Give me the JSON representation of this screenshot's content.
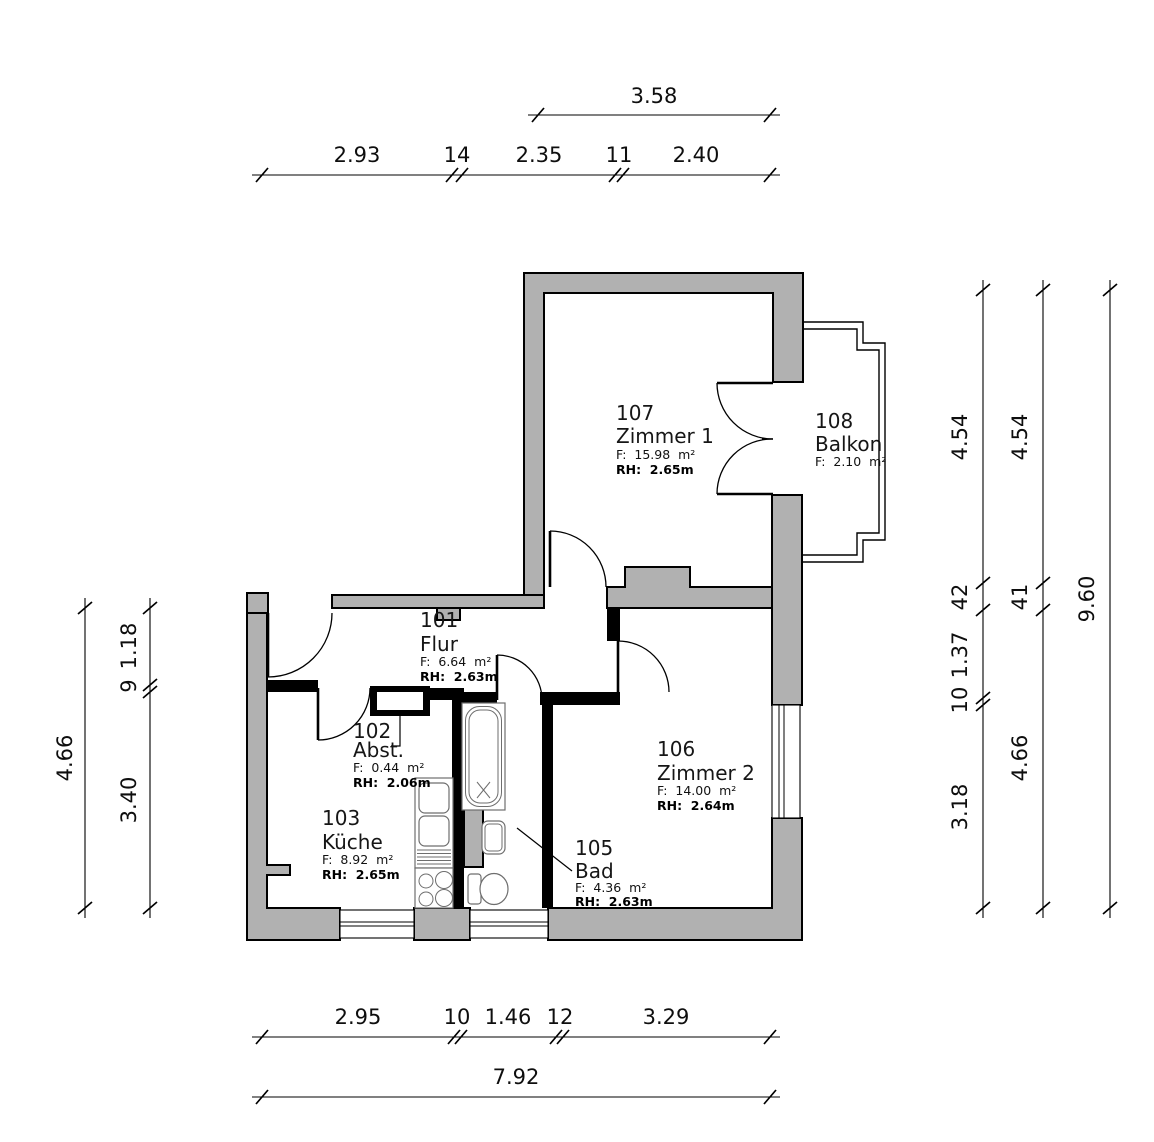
{
  "plan": {
    "colors": {
      "wall_fill": "#b1b1b1",
      "line": "#000000",
      "background": "#ffffff"
    },
    "rooms": {
      "flur": {
        "num": "101",
        "name": "Flur",
        "area": "F:  6.64  m²",
        "rh": "RH:  2.63m"
      },
      "abst": {
        "num": "102",
        "name": "Abst.",
        "area": "F:  0.44  m²",
        "rh": "RH:  2.06m"
      },
      "kueche": {
        "num": "103",
        "name": "Küche",
        "area": "F:  8.92  m²",
        "rh": "RH:  2.65m"
      },
      "bad": {
        "num": "105",
        "name": "Bad",
        "area": "F:  4.36  m²",
        "rh": "RH:  2.63m"
      },
      "zimmer2": {
        "num": "106",
        "name": "Zimmer 2",
        "area": "F:  14.00  m²",
        "rh": "RH:  2.64m"
      },
      "zimmer1": {
        "num": "107",
        "name": "Zimmer 1",
        "area": "F:  15.98  m²",
        "rh": "RH:  2.65m"
      },
      "balkon": {
        "num": "108",
        "name": "Balkon",
        "area": "F:  2.10  m²"
      }
    },
    "dims": {
      "top_total": "3.58",
      "top_chain": [
        "2.93",
        "14",
        "2.35",
        "11",
        "2.40"
      ],
      "bottom_chain": [
        "2.95",
        "10",
        "1.46",
        "12",
        "3.29"
      ],
      "bottom_total": "7.92",
      "left_total": "4.66",
      "left_chain": [
        "1.18",
        "9",
        "3.40"
      ],
      "right_inner": [
        "4.54",
        "42",
        "1.37",
        "10",
        "3.18"
      ],
      "right_mid": [
        "4.54",
        "41",
        "4.66"
      ],
      "right_total": "9.60"
    }
  }
}
